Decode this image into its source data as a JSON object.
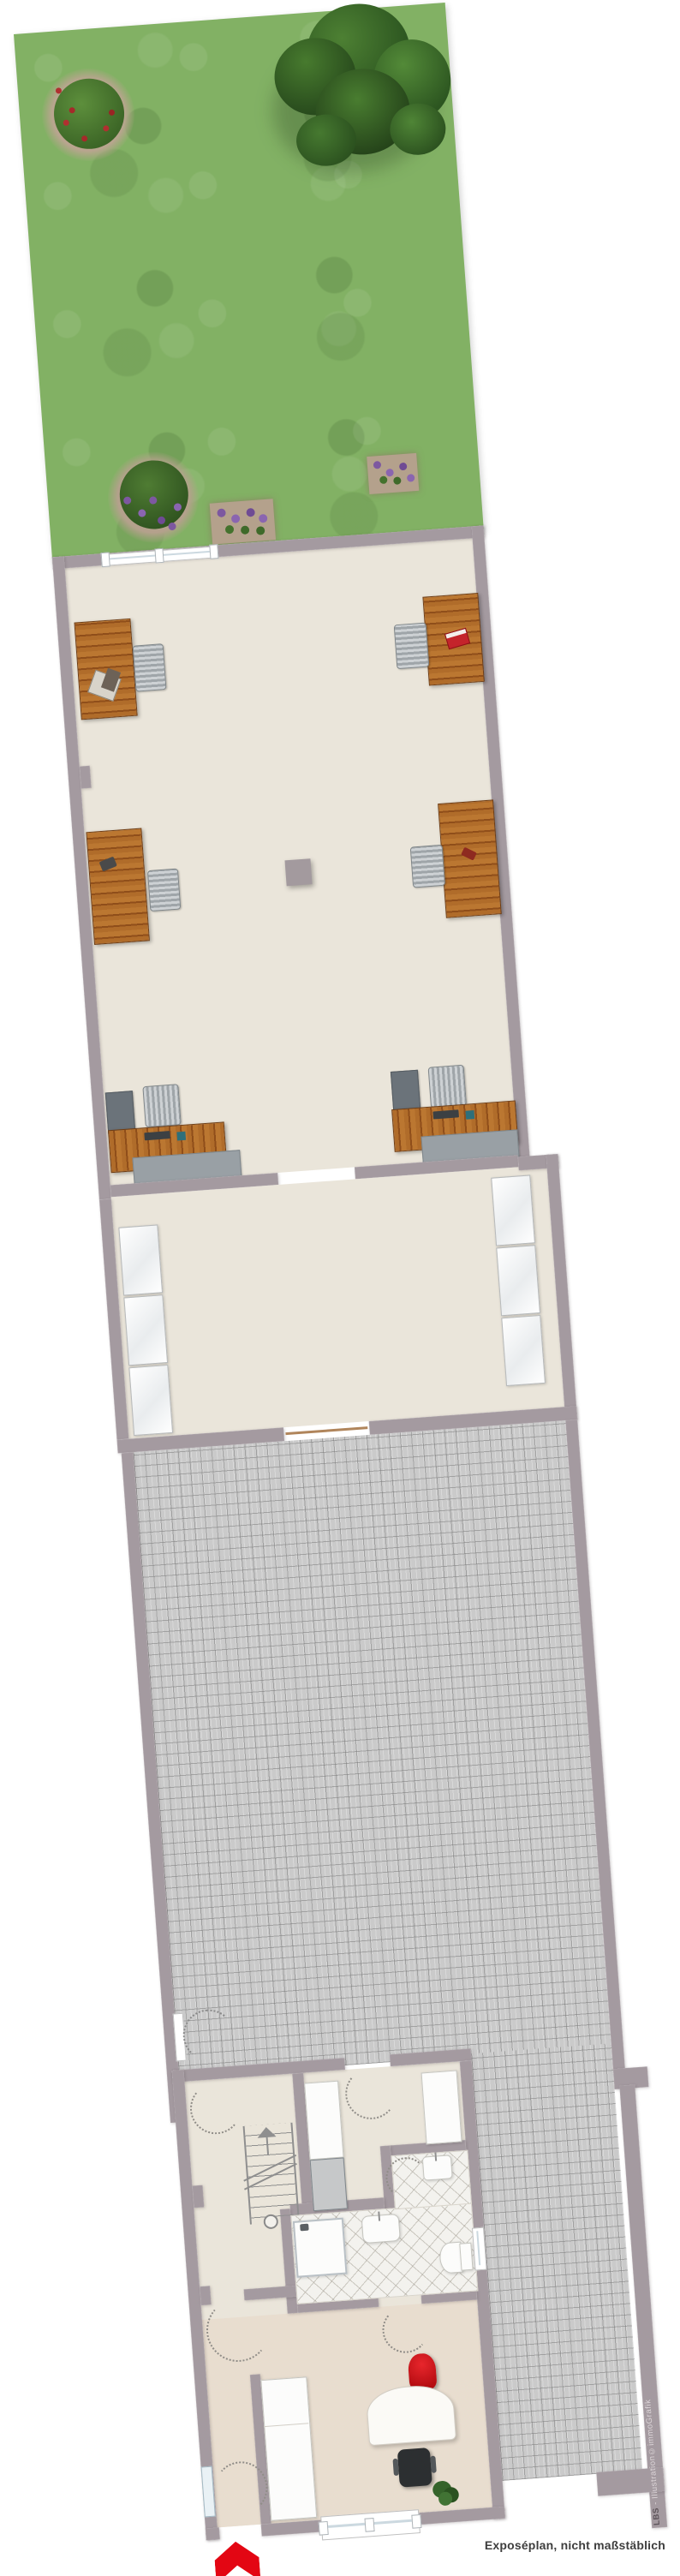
{
  "caption": {
    "text": "Exposéplan, nicht maßstäblich"
  },
  "watermark": {
    "brand": "LBS",
    "rest": " - Illustration©immoGrafik"
  },
  "colors": {
    "wall": "#a49aa0",
    "floor": "#eae5da",
    "grass": "#82b164",
    "paving": "#cacaca",
    "wood": "#a96426",
    "accent_red": "#e30613",
    "caption_text": "#3e3e3e"
  },
  "legend": {
    "areas": [
      "garden",
      "showroom",
      "corridor-room",
      "paved-courtyard",
      "rear-building"
    ],
    "garden_items": [
      "tree",
      "flower-bush",
      "flower-bush-purple",
      "flower-bed",
      "flower-bed"
    ],
    "showroom_items": [
      "desk",
      "desk",
      "desk",
      "desk",
      "desk",
      "desk",
      "office-chair-x6",
      "pillar",
      "window"
    ],
    "corridor_items": [
      "sideboard-left-x3",
      "sideboard-right-x3"
    ],
    "rear_building_items": [
      "staircase",
      "wardrobe",
      "shower",
      "washbasin",
      "washbasin",
      "toilet",
      "office-desk",
      "office-chair",
      "visitor-chair",
      "plant",
      "entrance-arrow",
      "window"
    ]
  }
}
